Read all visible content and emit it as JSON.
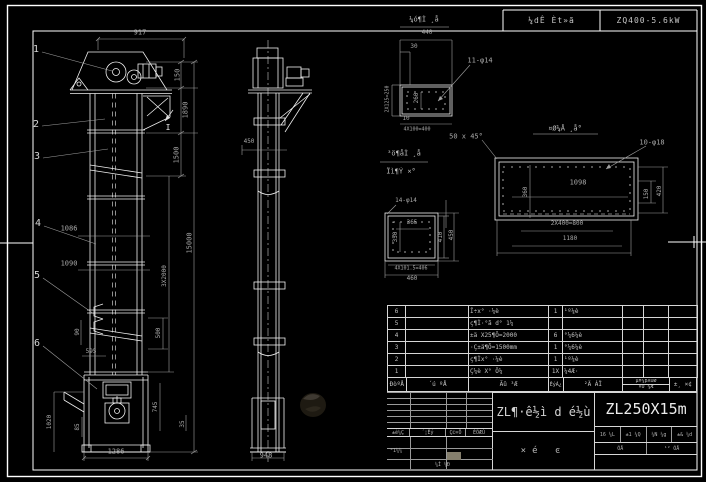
{
  "page": {
    "background": "#000000",
    "line_color": "#f0f0f0",
    "dim_color": "#a8a8a8",
    "border_color": "#ffffff",
    "model_color": "#ececec"
  },
  "top_strip": {
    "left": "¼dÊ Èt»ã",
    "right": "ZQ400-5.6kW"
  },
  "front_view": {
    "labels": [
      {
        "t": "1",
        "x": 36,
        "y": 50,
        "s": 10,
        "c": "#d4d4d4",
        "n": "balloon-1"
      },
      {
        "t": "2",
        "x": 36,
        "y": 125,
        "s": 10,
        "c": "#d4d4d4",
        "n": "balloon-2"
      },
      {
        "t": "3",
        "x": 37,
        "y": 157,
        "s": 10,
        "c": "#d4d4d4",
        "n": "balloon-3"
      },
      {
        "t": "4",
        "x": 38,
        "y": 224,
        "s": 10,
        "c": "#d4d4d4",
        "n": "balloon-4"
      },
      {
        "t": "5",
        "x": 37,
        "y": 276,
        "s": 10,
        "c": "#d4d4d4",
        "n": "balloon-5"
      },
      {
        "t": "6",
        "x": 37,
        "y": 344,
        "s": 10,
        "c": "#d4d4d4",
        "n": "balloon-6"
      },
      {
        "t": "917",
        "x": 140,
        "y": 33,
        "n": "dim-917"
      },
      {
        "t": "150",
        "x": 178,
        "y": 75,
        "r": 1,
        "n": "dim-150"
      },
      {
        "t": "1890",
        "x": 186,
        "y": 110,
        "r": 1,
        "n": "dim-1890"
      },
      {
        "t": "1500",
        "x": 177,
        "y": 155,
        "r": 1,
        "n": "dim-1500"
      },
      {
        "t": "15000",
        "x": 190,
        "y": 243,
        "r": 1,
        "n": "dim-15000"
      },
      {
        "t": "3X2000",
        "x": 165,
        "y": 276,
        "r": 1,
        "s": 6,
        "n": "dim-3x2000"
      },
      {
        "t": "1086",
        "x": 69,
        "y": 229,
        "n": "dim-1086"
      },
      {
        "t": "1090",
        "x": 69,
        "y": 264,
        "n": "dim-1090"
      },
      {
        "t": "90",
        "x": 78,
        "y": 332,
        "r": 1,
        "s": 6,
        "n": "dim-90"
      },
      {
        "t": "595",
        "x": 91,
        "y": 352,
        "s": 6,
        "n": "dim-595"
      },
      {
        "t": "500",
        "x": 159,
        "y": 333,
        "r": 1,
        "s": 6,
        "n": "dim-500"
      },
      {
        "t": "745",
        "x": 156,
        "y": 407,
        "r": 1,
        "s": 6,
        "n": "dim-745"
      },
      {
        "t": "35",
        "x": 183,
        "y": 424,
        "r": 1,
        "s": 6,
        "n": "dim-35"
      },
      {
        "t": "1020",
        "x": 50,
        "y": 422,
        "r": 1,
        "s": 6,
        "n": "dim-1020"
      },
      {
        "t": "85",
        "x": 78,
        "y": 427,
        "r": 1,
        "s": 6,
        "n": "dim-85"
      },
      {
        "t": "1286",
        "x": 116,
        "y": 452,
        "n": "dim-1286"
      },
      {
        "t": "I",
        "x": 168,
        "y": 128,
        "s": 8,
        "c": "#e8e8e8",
        "n": "section-mark-I"
      }
    ]
  },
  "side_view": {
    "labels": [
      {
        "t": "450",
        "x": 249,
        "y": 142,
        "s": 6,
        "n": "dim-450"
      },
      {
        "t": "948",
        "x": 266,
        "y": 456,
        "n": "dim-948"
      }
    ]
  },
  "detail_top": {
    "labels": [
      {
        "t": "¼ó¶Ì ¸å",
        "x": 424,
        "y": 20,
        "s": 7,
        "c": "#bdbdbd",
        "n": "detail-title"
      },
      {
        "t": "440",
        "x": 427,
        "y": 33,
        "s": 6,
        "n": "dim-440"
      },
      {
        "t": "30",
        "x": 414,
        "y": 47,
        "s": 6,
        "n": "dim-30"
      },
      {
        "t": "2X125=250",
        "x": 388,
        "y": 99,
        "r": 1,
        "s": 5,
        "n": "dim-2x125"
      },
      {
        "t": "260",
        "x": 417,
        "y": 98,
        "r": 1,
        "s": 6,
        "n": "dim-260"
      },
      {
        "t": "11-φ14",
        "x": 480,
        "y": 61,
        "s": 7,
        "n": "note-11-holes"
      },
      {
        "t": "10",
        "x": 406,
        "y": 119,
        "s": 6,
        "n": "dim-10"
      },
      {
        "t": "4X100=400",
        "x": 417,
        "y": 130,
        "s": 5,
        "n": "dim-4x100"
      }
    ]
  },
  "detail_right": {
    "labels": [
      {
        "t": "¤Ø¼Å ¸å°",
        "x": 565,
        "y": 129,
        "s": 7,
        "c": "#bdbdbd",
        "n": "detail-title"
      },
      {
        "t": "50 x 45°",
        "x": 466,
        "y": 137,
        "s": 7,
        "n": "note-chamfer"
      },
      {
        "t": "10-φ18",
        "x": 652,
        "y": 143,
        "s": 7,
        "n": "note-10-holes"
      },
      {
        "t": "1098",
        "x": 578,
        "y": 183,
        "n": "dim-1098"
      },
      {
        "t": "360",
        "x": 526,
        "y": 192,
        "r": 1,
        "s": 6,
        "n": "dim-360"
      },
      {
        "t": "150",
        "x": 647,
        "y": 194,
        "r": 1,
        "s": 6,
        "n": "dim-150b"
      },
      {
        "t": "420",
        "x": 660,
        "y": 191,
        "r": 1,
        "s": 6,
        "n": "dim-420"
      },
      {
        "t": "2X400=800",
        "x": 567,
        "y": 224,
        "s": 6,
        "n": "dim-2x400"
      },
      {
        "t": "1180",
        "x": 570,
        "y": 239,
        "s": 6,
        "n": "dim-1180"
      }
    ]
  },
  "detail_bottom": {
    "labels": [
      {
        "t": "³ö¶åÌ ¸å",
        "x": 404,
        "y": 154,
        "s": 7,
        "c": "#bdbdbd",
        "n": "detail-title-line1"
      },
      {
        "t": "Ïì¶Ý ×°",
        "x": 401,
        "y": 172,
        "s": 7,
        "c": "#bdbdbd",
        "n": "detail-title-line2"
      },
      {
        "t": "14-φ14",
        "x": 406,
        "y": 201,
        "s": 6,
        "n": "note-14-holes"
      },
      {
        "t": "365",
        "x": 412,
        "y": 223,
        "s": 6,
        "n": "dim-365"
      },
      {
        "t": "350",
        "x": 396,
        "y": 237,
        "r": 1,
        "s": 6,
        "n": "dim-350"
      },
      {
        "t": "410",
        "x": 441,
        "y": 237,
        "r": 1,
        "s": 6,
        "n": "dim-410"
      },
      {
        "t": "450",
        "x": 452,
        "y": 235,
        "r": 1,
        "s": 6,
        "n": "dim-450b"
      },
      {
        "t": "4X101.5=406",
        "x": 411,
        "y": 269,
        "s": 5,
        "n": "dim-4x101"
      },
      {
        "t": "460",
        "x": 412,
        "y": 279,
        "s": 6,
        "n": "dim-460"
      }
    ]
  },
  "bom": {
    "header": {
      "seq": "ÐòºÅ",
      "code": "´ú ºÅ",
      "name": "Ãû ³Æ",
      "qty": "ÊýÁ¿",
      "material": "²Ä ÁÏ",
      "weight_top": "µ¥¼þXÖØ",
      "weight_bottom": "×Ü ¼Æ",
      "note": "±¸ ×¢"
    },
    "rows": [
      [
        "6",
        "",
        "Î÷x° ·¼è",
        "1",
        "¹º¼è",
        "",
        "",
        ""
      ],
      [
        "5",
        "",
        "ç¶Ì·°ã d° 1¼",
        "",
        "",
        "",
        "",
        ""
      ],
      [
        "4",
        "",
        "±ä X25¶Õ=2000",
        "6",
        "°¼6¼è",
        "",
        "",
        ""
      ],
      [
        "3",
        "",
        "·Ç±ä¶Õ=1500mm",
        "1",
        "°¼6¼è",
        "",
        "",
        ""
      ],
      [
        "2",
        "",
        "ç¶Ìx° ·¼è",
        "1",
        "¹º¼è",
        "",
        "",
        ""
      ],
      [
        "1",
        "",
        "Ç¼è X° Ö¼",
        "1X",
        "¼4Æ·",
        "",
        "",
        ""
      ]
    ]
  },
  "title_block": {
    "main_title": "ZL¶·ê½ì d é½ù",
    "sub_title": "×é ͼ",
    "model": "ZL250X15m",
    "rev_headers": [
      "±ê¼Ç",
      "´¦Êý",
      "Ç©×Ö",
      "ÈÕÆÚ"
    ],
    "design_label": "°1¼¼",
    "check_label": "¼Ì ¼Ð",
    "info_cells": [
      "16 ¼L",
      "±1 ¼Q",
      "¼N ¼g",
      "±& ¼d"
    ],
    "sheet_cells": [
      "ÕÅ",
      "¹² ÕÅ"
    ]
  }
}
